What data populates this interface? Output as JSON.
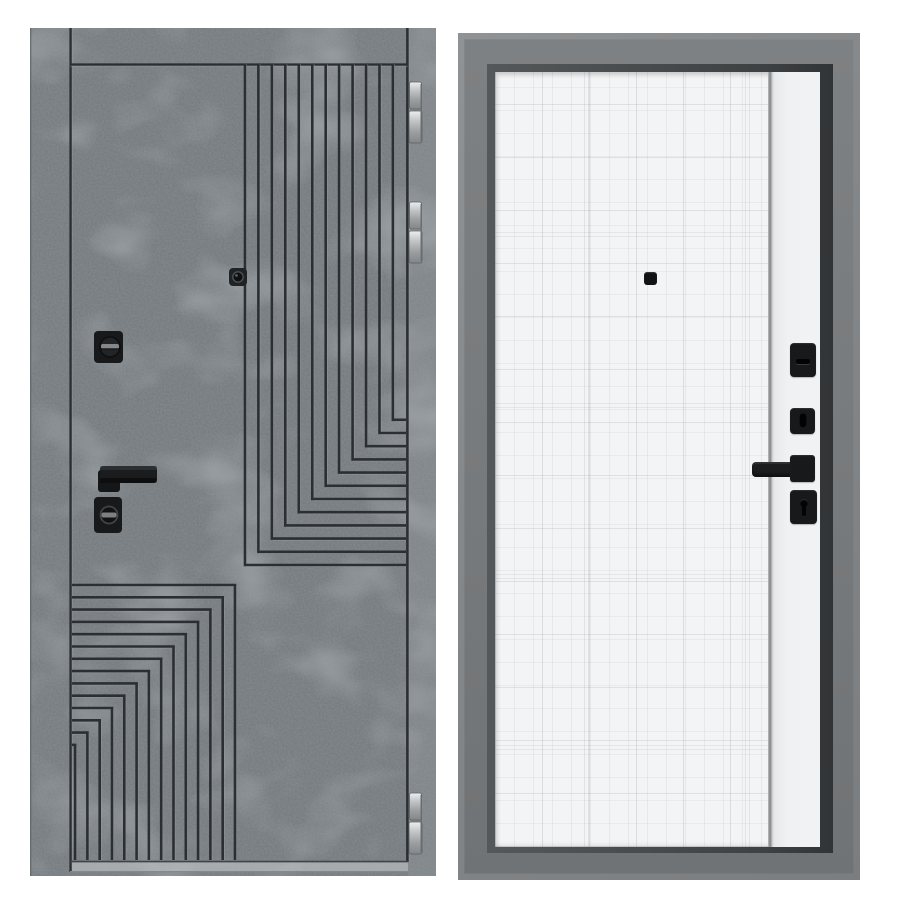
{
  "scene": {
    "background": "#ffffff",
    "width": 900,
    "height": 900,
    "subject": "steel entrance door product photo: exterior concrete-look side on the left, interior white side on the right",
    "visible_text": []
  },
  "left_door": {
    "kind": "exterior-panel",
    "x": 30,
    "y": 28,
    "width": 406,
    "height": 848,
    "colors": {
      "casing": "#757b7e",
      "leaf": "#747a7d",
      "jamb": "#7f8588",
      "groove": "#2b2f31",
      "groove_highlight": "#a3aaad",
      "threshold": "#a9adaf",
      "hardware_black": "#17191b",
      "hinge_light": "#eceeee",
      "hinge_dark": "#82868a"
    },
    "layout": {
      "casing_left_w": 40,
      "jamb_right_x": 378,
      "top_band_h": 36,
      "leaf_bottom_y": 834,
      "threshold": {
        "x": 40,
        "y": 834,
        "w": 338,
        "h": 10
      }
    },
    "patterns": {
      "top_right": {
        "count": 12,
        "x0": 215,
        "dx": 13.45,
        "y_top": 36,
        "corner_y0": 537,
        "dy": -13.2,
        "x_end": 376
      },
      "bottom_left": {
        "count": 14,
        "x_left": 42,
        "corner_x0": 205,
        "dx": -12.3,
        "corner_y0": 557,
        "dy": 12.3,
        "y_bottom": 832
      }
    },
    "hinges": [
      {
        "y": 54
      },
      {
        "y": 174
      },
      {
        "y": 765
      }
    ],
    "hardware": [
      "peephole",
      "thumbturn-deadbolt",
      "lever-handle",
      "cylinder-escutcheon"
    ]
  },
  "right_door": {
    "kind": "interior-panel",
    "x": 458,
    "y": 33,
    "width": 402,
    "height": 847,
    "colors": {
      "frame_lip": "#85888a",
      "frame_face": "#777a7c",
      "inner_bevel": "#3e4143",
      "panel": "#f3f4f6",
      "plaid_line": "#788086",
      "accent_groove": "#7e8284",
      "strip": "#f0f1f3",
      "hardware_black": "#17191b"
    },
    "accent_line_x": 273,
    "hardware": [
      "peephole",
      "thumbturn-plate",
      "keyhole-plate",
      "lever-handle",
      "lock-plate"
    ]
  }
}
